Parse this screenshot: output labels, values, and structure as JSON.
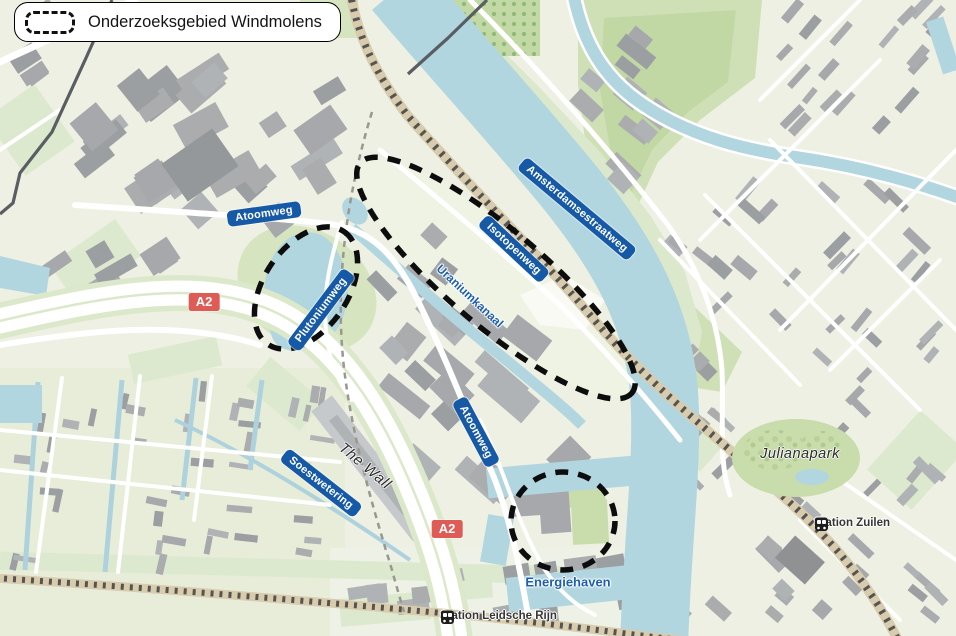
{
  "legend": {
    "title": "Onderzoeksgebied Windmolens"
  },
  "map": {
    "road_badges": {
      "atoomweg_north": "Atoomweg",
      "plutoniumweg": "Plutoniumweg",
      "isotopenweg": "Isotopenweg",
      "amsterdamsestraatweg": "Amsterdamsestraatweg",
      "atoomweg_south": "Atoomweg",
      "soestwetering": "Soestwetering"
    },
    "highway_badges": {
      "a2_north": "A2",
      "a2_south": "A2"
    },
    "water_labels": {
      "uraniumkanaal": "Uraniumkanaal",
      "energiehaven": "Energiehaven"
    },
    "place_labels": {
      "the_wall": "The Wall",
      "julianapark": "Julianapark"
    },
    "stations": {
      "zuilen": "Station Zuilen",
      "leidsche_rijn": "Station Leidsche Rijn"
    }
  },
  "colors": {
    "badge_blue": "#1659a6",
    "highway_red": "#df5b55",
    "water": "#b2d6e0",
    "park_green": "#cfe0b6",
    "building_gray": "#a6a8ab",
    "research_outline": "#0d0d0d",
    "railway_tan": "#d9ccae"
  }
}
